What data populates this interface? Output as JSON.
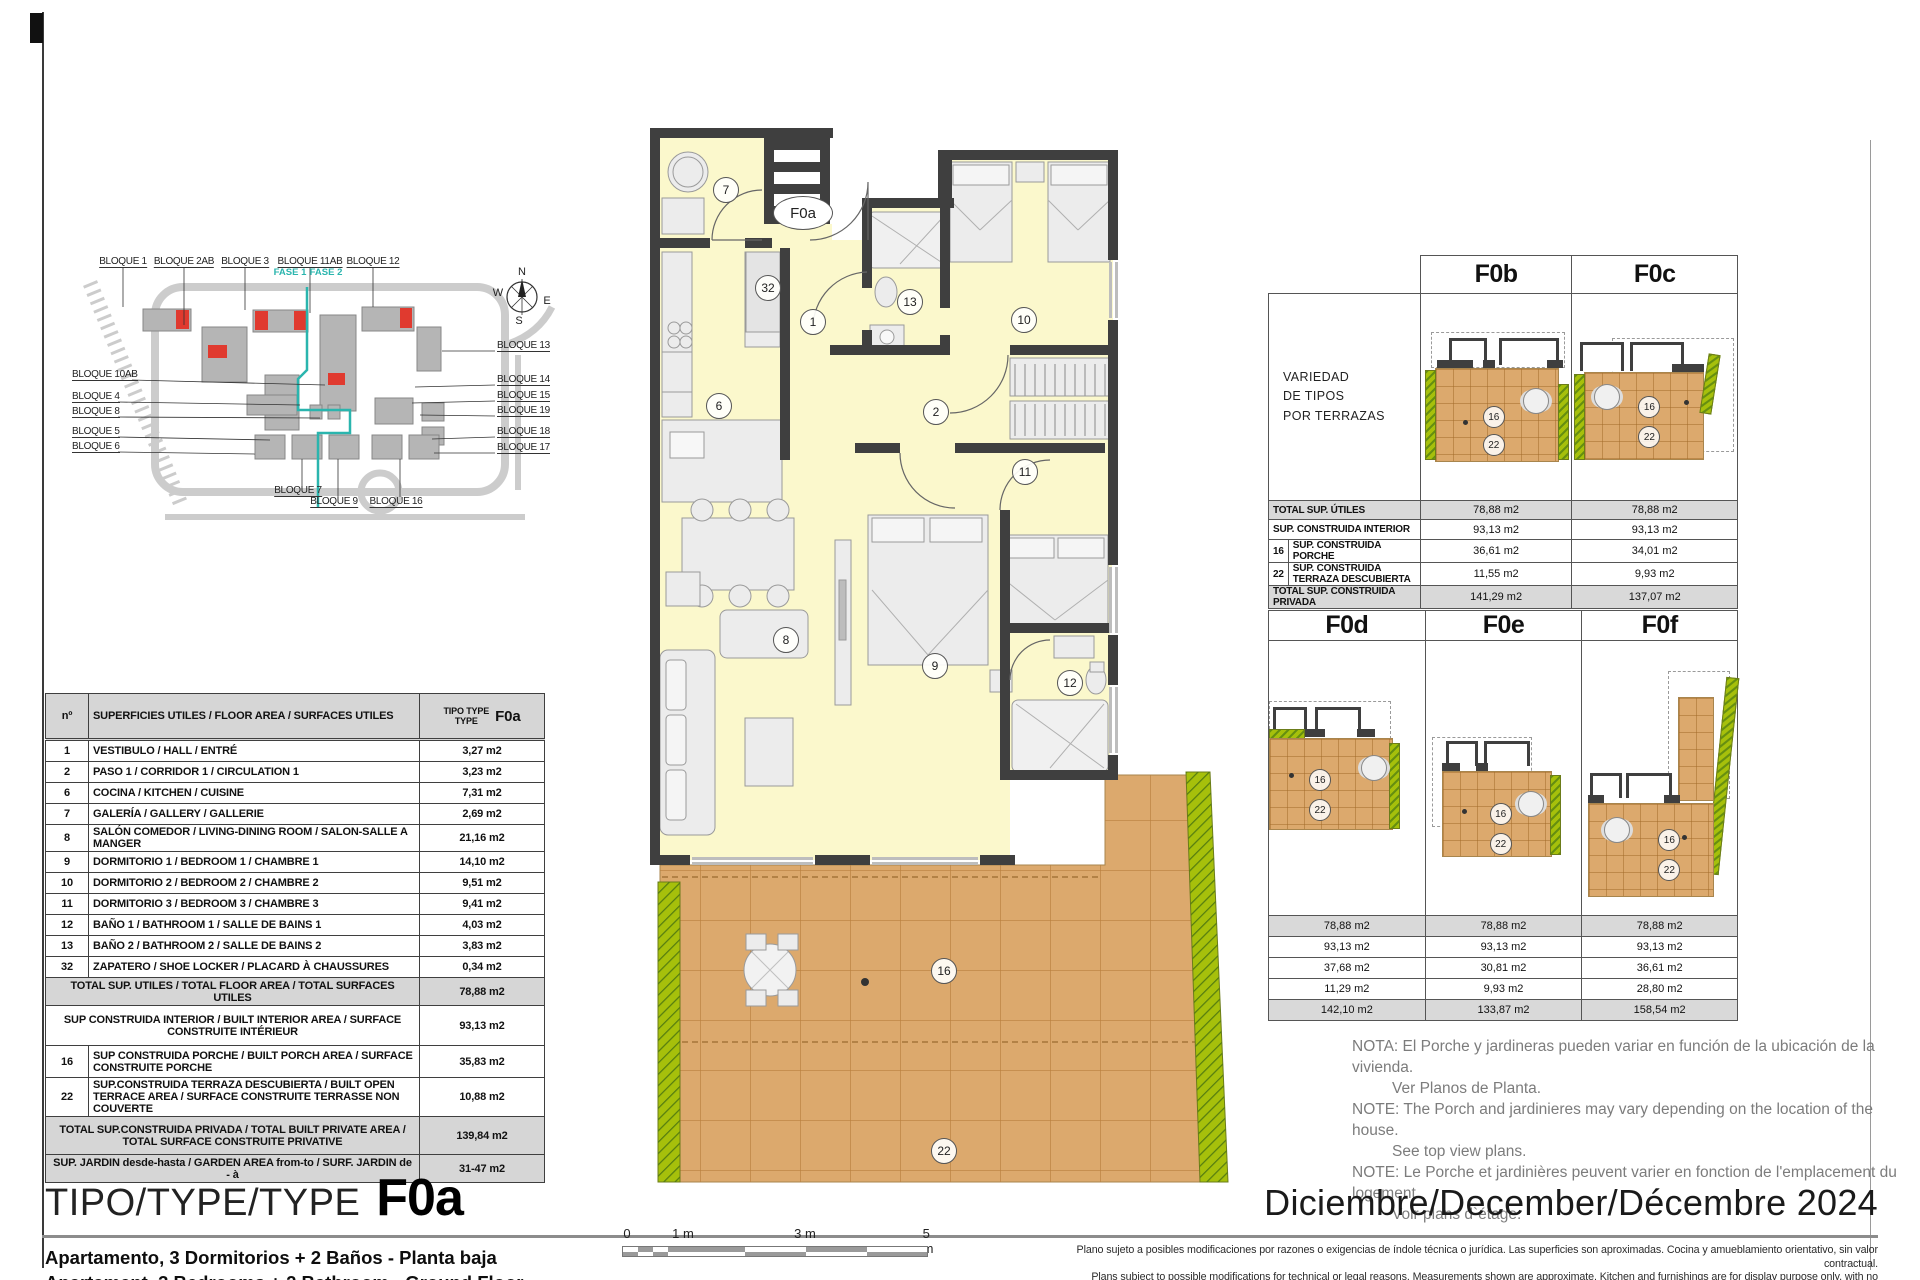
{
  "page": {
    "title_label": "TIPO/TYPE/TYPE",
    "type_code": "F0a",
    "date": "Diciembre/December/Décembre 2024",
    "subtitles": [
      "Apartamento, 3 Dormitorios + 2 Baños - Planta baja",
      "Apartament, 3 Bedrooms + 2 Bathroom - Ground Floor",
      "Appartament, 3 Chambres + 2 Salle de bains - Rez-de-chaussée"
    ],
    "disclaimer": [
      "Plano sujeto a posibles modificaciones por razones o exigencias de índole técnica o jurídica. Las superficies son aproximadas. Cocina y amueblamiento orientativo, sin valor contractual.",
      "Plans subject to possible modifications for technical or legal reasons. Measurements shown are approximate. Kitchen and furnishings are for display purpose only, with no contractual value.",
      "Plan soumis à modifications en fonction des besoins ou exigences d'ordre technique ou juridique. Les surfaces sont approximative. Cousine et ameublement indicatifs, sans valeur contratuelle."
    ]
  },
  "colors": {
    "wall": "#3f3f3f",
    "interior": "#fbf8cc",
    "terrace": "#dca96d",
    "terrace_grid": "#b97f3e",
    "planter": "#a6c00b",
    "highlight_red": "#e03a2f",
    "phase_teal": "#2ab5ae",
    "table_gray": "#d6d6d6"
  },
  "site_plan": {
    "labels": [
      "BLOQUE 1",
      "BLOQUE 2AB",
      "BLOQUE 3",
      "BLOQUE 11AB",
      "BLOQUE 12",
      "BLOQUE 10AB",
      "BLOQUE 4",
      "BLOQUE 8",
      "BLOQUE 5",
      "BLOQUE 6",
      "BLOQUE 13",
      "BLOQUE 14",
      "BLOQUE 15",
      "BLOQUE 19",
      "BLOQUE 18",
      "BLOQUE 17",
      "BLOQUE 7",
      "BLOQUE 9",
      "BLOQUE 16"
    ],
    "fase": [
      "FASE 1",
      "FASE 2"
    ],
    "compass": {
      "n": "N",
      "w": "W",
      "e": "E",
      "s": "S"
    }
  },
  "floor_plan": {
    "unit_label": "F0a",
    "rooms": [
      "7",
      "32",
      "1",
      "13",
      "10",
      "6",
      "2",
      "11",
      "8",
      "9",
      "12",
      "16",
      "22"
    ]
  },
  "area_table": {
    "header": {
      "num": "nº",
      "desc": "SUPERFICIES UTILES / FLOOR AREA / SURFACES UTILES",
      "tipo_line1": "TIPO TYPE",
      "tipo_line2": "TYPE",
      "code": "F0a"
    },
    "rows": [
      {
        "n": "1",
        "desc": "VESTIBULO / HALL / ENTRÉ",
        "val": "3,27 m2"
      },
      {
        "n": "2",
        "desc": "PASO 1 / CORRIDOR 1 / CIRCULATION 1",
        "val": "3,23 m2"
      },
      {
        "n": "6",
        "desc": "COCINA / KITCHEN / CUISINE",
        "val": "7,31 m2"
      },
      {
        "n": "7",
        "desc": "GALERÍA / GALLERY / GALLERIE",
        "val": "2,69 m2"
      },
      {
        "n": "8",
        "desc": "SALÓN COMEDOR / LIVING-DINING ROOM / SALON-SALLE A MANGER",
        "val": "21,16 m2"
      },
      {
        "n": "9",
        "desc": "DORMITORIO 1 / BEDROOM 1 / CHAMBRE 1",
        "val": "14,10 m2"
      },
      {
        "n": "10",
        "desc": "DORMITORIO 2 / BEDROOM 2 / CHAMBRE 2",
        "val": "9,51 m2"
      },
      {
        "n": "11",
        "desc": "DORMITORIO 3 / BEDROOM 3 / CHAMBRE 3",
        "val": "9,41 m2"
      },
      {
        "n": "12",
        "desc": "BAÑO 1 / BATHROOM 1 / SALLE DE BAINS 1",
        "val": "4,03 m2"
      },
      {
        "n": "13",
        "desc": "BAÑO 2 / BATHROOM 2 / SALLE DE BAINS 2",
        "val": "3,83 m2"
      },
      {
        "n": "32",
        "desc": "ZAPATERO / SHOE LOCKER / PLACARD À CHAUSSURES",
        "val": "0,34 m2"
      }
    ],
    "total_utiles": {
      "desc": "TOTAL SUP. UTILES / TOTAL FLOOR AREA / TOTAL SURFACES UTILES",
      "val": "78,88 m2"
    },
    "construida_interior": {
      "desc": "SUP CONSTRUIDA INTERIOR / BUILT INTERIOR AREA /  SURFACE CONSTRUITE INTÉRIEUR",
      "val": "93,13 m2"
    },
    "porche": {
      "n": "16",
      "desc": "SUP CONSTRUIDA PORCHE  / BUILT PORCH  AREA / SURFACE CONSTRUITE PORCHE",
      "val": "35,83 m2"
    },
    "terraza": {
      "n": "22",
      "desc": "SUP.CONSTRUIDA TERRAZA DESCUBIERTA  / BUILT OPEN TERRACE  AREA / SURFACE CONSTRUITE TERRASSE NON COUVERTE",
      "val": "10,88 m2"
    },
    "total_privada": {
      "desc": "TOTAL SUP.CONSTRUIDA PRIVADA / TOTAL  BUILT PRIVATE AREA / TOTAL SURFACE CONSTRUITE PRIVATIVE",
      "val": "139,84 m2"
    },
    "jardin": {
      "desc": "SUP. JARDIN desde-hasta / GARDEN AREA from-to / SURF. JARDIN  de - à",
      "val": "31-47 m2"
    }
  },
  "variants_top": {
    "note_lines": [
      "VARIEDAD",
      "DE TIPOS",
      "POR TERRAZAS"
    ],
    "cols": [
      "F0b",
      "F0c"
    ],
    "rows": [
      {
        "n": "",
        "label": "TOTAL SUP. ÚTILES",
        "v1": "78,88 m2",
        "v2": "78,88 m2"
      },
      {
        "n": "",
        "label": "SUP. CONSTRUIDA INTERIOR",
        "v1": "93,13 m2",
        "v2": "93,13 m2"
      },
      {
        "n": "16",
        "label": "SUP. CONSTRUIDA PORCHE",
        "v1": "36,61 m2",
        "v2": "34,01 m2"
      },
      {
        "n": "22",
        "label": "SUP. CONSTRUIDA TERRAZA DESCUBIERTA",
        "v1": "11,55 m2",
        "v2": "9,93 m2"
      },
      {
        "n": "",
        "label": "TOTAL SUP. CONSTRUIDA PRIVADA",
        "v1": "141,29 m2",
        "v2": "137,07 m2"
      }
    ]
  },
  "variants_bottom": {
    "cols": [
      "F0d",
      "F0e",
      "F0f"
    ],
    "rows": [
      {
        "v1": "78,88 m2",
        "v2": "78,88 m2",
        "v3": "78,88 m2"
      },
      {
        "v1": "93,13 m2",
        "v2": "93,13 m2",
        "v3": "93,13 m2"
      },
      {
        "v1": "37,68 m2",
        "v2": "30,81 m2",
        "v3": "36,61 m2"
      },
      {
        "v1": "11,29 m2",
        "v2": "9,93 m2",
        "v3": "28,80 m2"
      },
      {
        "v1": "142,10 m2",
        "v2": "133,87 m2",
        "v3": "158,54 m2"
      }
    ]
  },
  "variants_plan": {
    "porch": "16",
    "terrace": "22"
  },
  "nota": [
    "NOTA: El Porche y jardineras pueden variar en función de la ubicación de la vivienda.",
    "Ver Planos de Planta.",
    "NOTE: The Porch and jardinieres may vary depending on the location of the house.",
    "See top view plans.",
    "NOTE: Le Porche et jardinières peuvent varier en fonction de l'emplacement du logement.",
    "Voir plans d`étage."
  ],
  "scale_bar": {
    "labels": [
      "0",
      "1 m",
      "3 m",
      "5 m"
    ]
  }
}
